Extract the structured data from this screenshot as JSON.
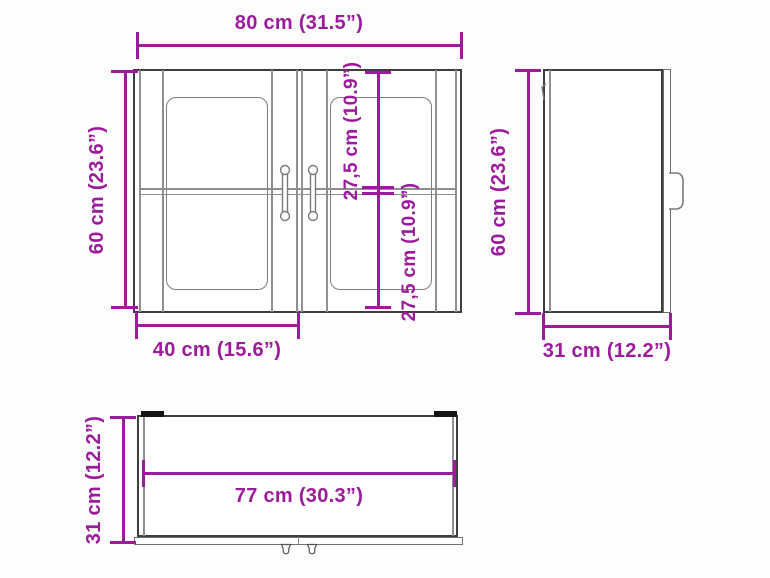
{
  "diagram_title": "Wall cabinet dimension drawing",
  "colors": {
    "dimension_accent": "#9C1A9C",
    "outline": "#3E3E3E",
    "secondary_line": "#8F8F8F",
    "hinge_mark": "#141414",
    "background": "#FDFDFD"
  },
  "front_view": {
    "overall_width": "80 cm (31.5”)",
    "overall_height": "60 cm (23.6”)",
    "upper_section_height": "27,5 cm (10.9”)",
    "lower_section_height": "27,5 cm (10.9”)",
    "door_width": "40 cm (15.6”)"
  },
  "side_view": {
    "height": "60 cm (23.6”)",
    "depth": "31 cm (12.2”)"
  },
  "top_view": {
    "depth": "31 cm (12.2”)",
    "inner_width": "77 cm (30.3”)"
  }
}
